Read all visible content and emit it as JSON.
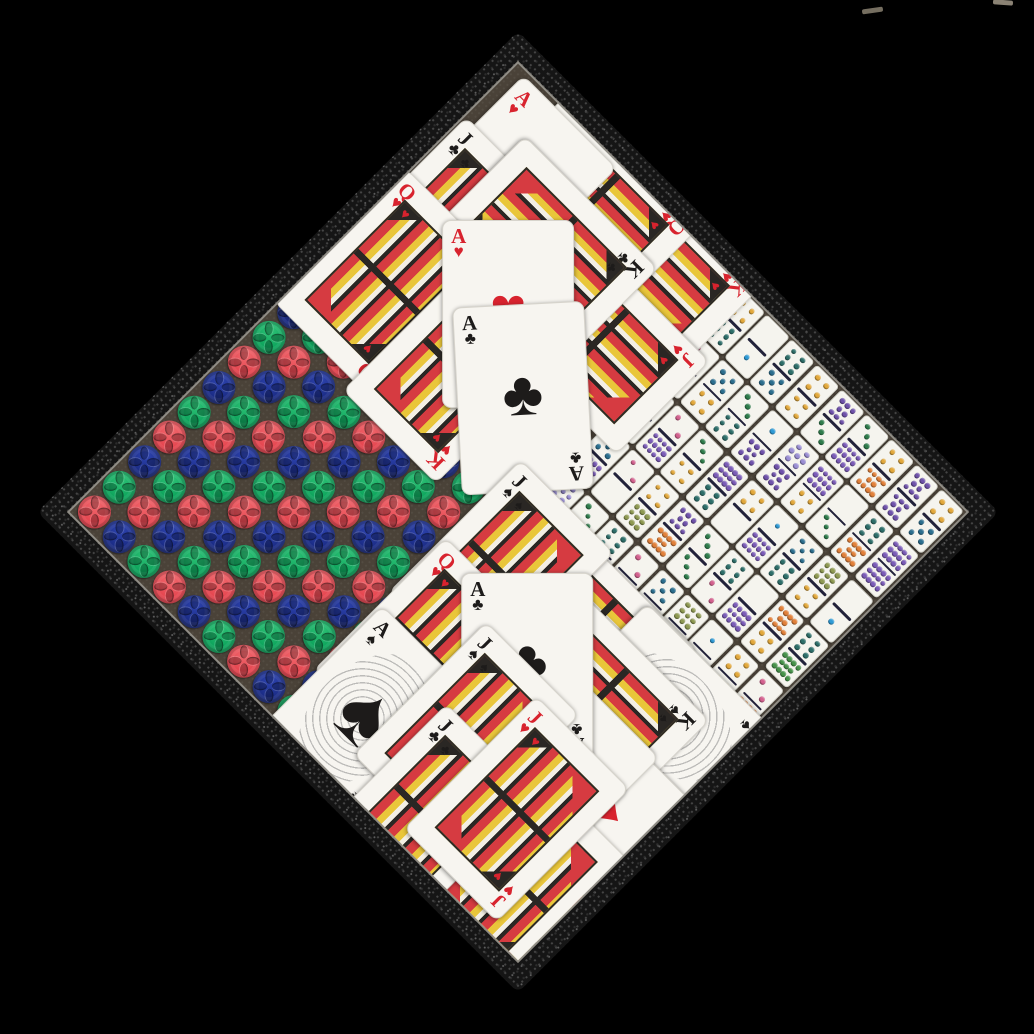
{
  "scene": {
    "background": "#000000",
    "artifacts": [
      {
        "x": 862,
        "y": 8,
        "w": 21,
        "h": 5,
        "rot": -8,
        "color": "#756e60"
      },
      {
        "x": 993,
        "y": 0,
        "w": 20,
        "h": 5,
        "rot": 4,
        "color": "#8a8274"
      }
    ],
    "board": {
      "foam_color": "#151515",
      "felt_color": "#4a4238",
      "frame_color": "#8f8c85",
      "rotation_deg": 45
    }
  },
  "chips": {
    "grid": 9,
    "cycle_order": [
      "blue",
      "green",
      "red"
    ],
    "colors": {
      "blue": [
        "#2e44b0",
        "#1b2c85",
        "#0f1a52"
      ],
      "green": [
        "#2fc276",
        "#0da45c",
        "#067a40"
      ],
      "red": [
        "#f06a6f",
        "#e5454f",
        "#af2832"
      ]
    }
  },
  "dominoes": {
    "cols": 9,
    "rows": 5,
    "body_color": "#f5f4ee",
    "line_color": "#22223a",
    "pip_colors": {
      "1": "#2f9bd6",
      "2": "#d4628f",
      "3": "#2f7d4c",
      "4": "#e3a93c",
      "5": "#2c6f8f",
      "6": "#2e6f6a",
      "7": "#9b8fd4",
      "8": "#6f52ab",
      "9": "#8f9a52",
      "10": "#e2813a",
      "11": "#47934a",
      "12": "#7b5cb8"
    },
    "tiles": [
      [
        4,
        6
      ],
      [
        0,
        1
      ],
      [
        6,
        5
      ],
      [
        4,
        4
      ],
      [
        8,
        3
      ],
      [
        3,
        12
      ],
      [
        4,
        10
      ],
      [
        8,
        8
      ],
      [
        4,
        5
      ],
      [
        2,
        3
      ],
      [
        5,
        4
      ],
      [
        3,
        6
      ],
      [
        1,
        8
      ],
      [
        7,
        8
      ],
      [
        12,
        4
      ],
      [
        0,
        3
      ],
      [
        6,
        10
      ],
      [
        12,
        12
      ],
      [
        8,
        5
      ],
      [
        2,
        12
      ],
      [
        3,
        4
      ],
      [
        12,
        6
      ],
      [
        4,
        0
      ],
      [
        1,
        12
      ],
      [
        5,
        6
      ],
      [
        9,
        4
      ],
      [
        0,
        1
      ],
      [
        5,
        12
      ],
      [
        2,
        0
      ],
      [
        4,
        9
      ],
      [
        8,
        10
      ],
      [
        3,
        3
      ],
      [
        6,
        2
      ],
      [
        0,
        12
      ],
      [
        10,
        4
      ],
      [
        6,
        11
      ],
      [
        7,
        5
      ],
      [
        3,
        11
      ],
      [
        6,
        4
      ],
      [
        2,
        8
      ],
      [
        5,
        0
      ],
      [
        9,
        12
      ],
      [
        1,
        3
      ],
      [
        4,
        4
      ],
      [
        2,
        10
      ]
    ]
  },
  "cards": {
    "size": {
      "w": 132,
      "h": 188
    },
    "red_color": "#d8232e",
    "black_color": "#1d1b1a",
    "suit_glyphs": {
      "hearts": "♥",
      "diamonds": "♦",
      "clubs": "♣",
      "spades": "♠"
    },
    "top": [
      {
        "rank": "K",
        "suit": "hearts",
        "type": "face",
        "x": 236,
        "y": 52,
        "rot": 90
      },
      {
        "rank": "Q",
        "suit": "hearts",
        "type": "face",
        "x": 150,
        "y": 52,
        "rot": 90
      },
      {
        "rank": "J",
        "suit": "hearts",
        "type": "face",
        "x": 252,
        "y": 141,
        "rot": 90
      },
      {
        "rank": "A",
        "suit": "hearts",
        "type": "ace",
        "x": 78,
        "y": 98,
        "rot": 0
      },
      {
        "rank": "",
        "suit": "",
        "type": "blank",
        "x": 140,
        "y": 150,
        "rot": 0
      },
      {
        "rank": "J",
        "suit": "clubs",
        "type": "face",
        "x": 67,
        "y": 168,
        "rot": 0
      },
      {
        "rank": "K",
        "suit": "clubs",
        "type": "face",
        "x": 150,
        "y": 112,
        "rot": 90
      },
      {
        "rank": "Q",
        "suit": "hearts",
        "type": "face",
        "x": 61,
        "y": 247,
        "rot": 0
      },
      {
        "rank": "K",
        "suit": "hearts",
        "type": "face",
        "x": 173,
        "y": 261,
        "rot": 0
      },
      {
        "rank": "A",
        "suit": "hearts",
        "type": "ace",
        "x": 170,
        "y": 184,
        "rot": -45
      },
      {
        "rank": "A",
        "suit": "clubs",
        "type": "ace",
        "x": 240,
        "y": 233,
        "rot": -48
      }
    ],
    "bottom": [
      {
        "rank": "K",
        "suit": "diamonds",
        "type": "face",
        "x": 132,
        "y": 37,
        "rot": 90
      },
      {
        "rank": "A",
        "suit": "spades",
        "type": "ace",
        "x": 250,
        "y": 39,
        "rot": 90
      },
      {
        "rank": "K",
        "suit": "spades",
        "type": "face",
        "x": 189,
        "y": 78,
        "rot": 90
      },
      {
        "rank": "A",
        "suit": "diamonds",
        "type": "ace",
        "x": 269,
        "y": 148,
        "rot": 90
      },
      {
        "rank": "",
        "suit": "",
        "type": "blank",
        "x": 180,
        "y": 140,
        "rot": 90
      },
      {
        "rank": "J",
        "suit": "spades",
        "type": "face",
        "x": 31,
        "y": 55,
        "rot": 0
      },
      {
        "rank": "Q",
        "suit": "hearts",
        "type": "face",
        "x": 33,
        "y": 163,
        "rot": 0
      },
      {
        "rank": "A",
        "suit": "spades",
        "type": "ace",
        "x": 36,
        "y": 256,
        "rot": 0
      },
      {
        "rank": "A",
        "suit": "clubs",
        "type": "ace",
        "x": 116,
        "y": 103,
        "rot": -45
      },
      {
        "rank": "K",
        "suit": "diamonds",
        "type": "face",
        "x": 292,
        "y": 295,
        "rot": 0
      },
      {
        "rank": "J",
        "suit": "diamonds",
        "type": "face",
        "x": 258,
        "y": 262,
        "rot": 0
      },
      {
        "rank": "J",
        "suit": "spades",
        "type": "face",
        "x": 121,
        "y": 194,
        "rot": 0
      },
      {
        "rank": "J",
        "suit": "clubs",
        "type": "face",
        "x": 151,
        "y": 280,
        "rot": 0
      },
      {
        "rank": "J",
        "suit": "hearts",
        "type": "face",
        "x": 209,
        "y": 211,
        "rot": 0
      }
    ]
  }
}
